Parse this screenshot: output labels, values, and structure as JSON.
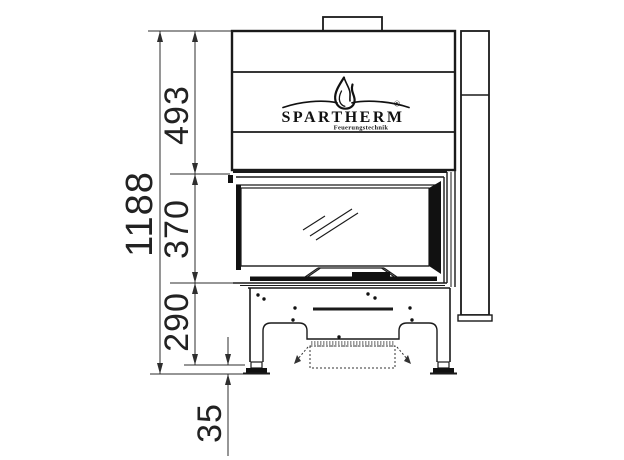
{
  "brand": {
    "wordmark": "SPARTHERM",
    "registered_mark": "®",
    "tagline": "Feuerungstechnik",
    "logo_icon": "flame-icon"
  },
  "dimensions_mm": {
    "total_height": "1188",
    "upper_body_height": "493",
    "firebox_glass_height": "370",
    "base_height": "290",
    "foot_clearance": "35"
  },
  "colors": {
    "line_art": "#1a1a1a",
    "dimension_lines": "#2e2e2e",
    "dimension_text": "#222222",
    "frame_fill": "#111111",
    "background": "#ffffff"
  }
}
